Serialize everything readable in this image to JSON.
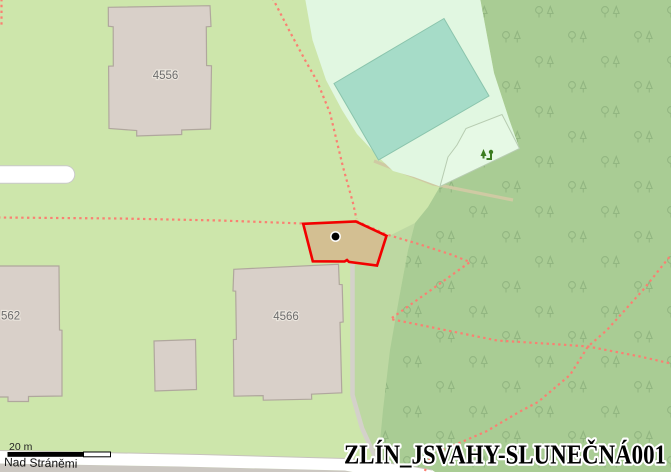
{
  "map": {
    "overlay_title": "ZLÍN_JSVAHY-SLUNEČNÁ001",
    "street_name": "Nad Stráněmi",
    "scale_bar": {
      "label": "20 m"
    },
    "buildings": [
      {
        "label": "4556"
      },
      {
        "label": "4566"
      },
      {
        "label": "562"
      }
    ],
    "parcel": {
      "outline_color": "#f20000",
      "fill_color": "#d3bf92",
      "marker": "black-dot"
    },
    "icons": [
      "tree-icon",
      "playground-icon",
      "parcel-marker-dot"
    ],
    "colors": {
      "meadow": "#cde6ab",
      "forest": "#a9cc94",
      "forest_edge_band": "#bdd8a2",
      "pitch_surround": "#e1f7e1",
      "pitch": "#a6dcc8",
      "building_fill": "#d9d0c9",
      "building_stroke": "#b0a79d",
      "path_dashed": "#fa8072",
      "road": "#ffffff",
      "road_side": "#cbc7c1",
      "driveway": "#d4d1ca",
      "dirt_band": "#cfcaa3",
      "playground_icon": "#3b7d1f"
    }
  }
}
